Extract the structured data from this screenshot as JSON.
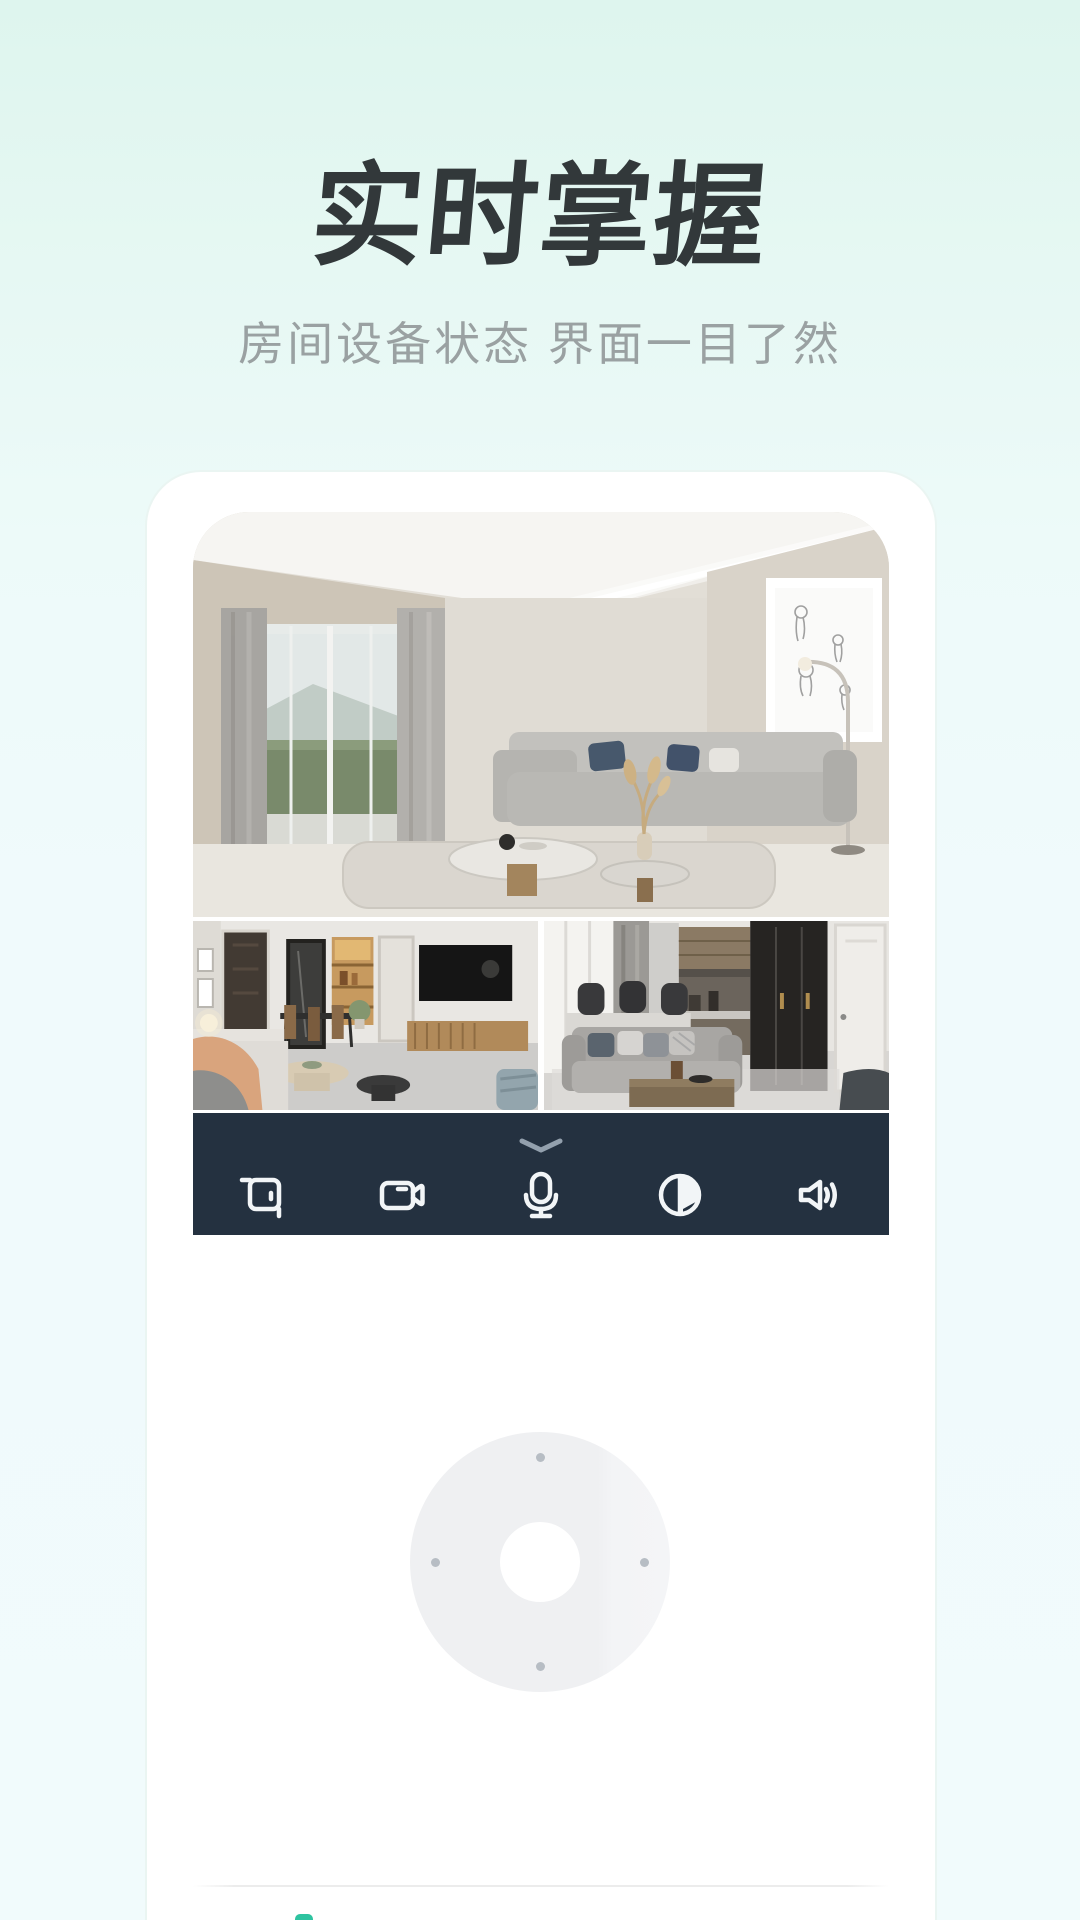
{
  "hero": {
    "title": "实时掌握",
    "subtitle": "房间设备状态 界面一目了然"
  },
  "colors": {
    "background_top": "#def5ee",
    "background_bottom": "#f1fbfc",
    "title_text": "#32383a",
    "subtitle_text": "#9aa1a2",
    "control_bar": "#243140",
    "icon_stroke": "#f2f5f7",
    "chevron": "#93a0ad",
    "dpad_ring": "#eff0f2",
    "dpad_dot": "#b7bdc4",
    "accent_teal": "#2ec3a0"
  },
  "camera": {
    "feeds": [
      {
        "id": "living-room-main",
        "kind": "main-view"
      },
      {
        "id": "dining-room",
        "kind": "thumbnail"
      },
      {
        "id": "lounge",
        "kind": "thumbnail"
      }
    ],
    "control_bar": {
      "collapse_icon": "chevron-down",
      "icons": [
        {
          "name": "crop-screenshot"
        },
        {
          "name": "video-record"
        },
        {
          "name": "microphone"
        },
        {
          "name": "contrast-theme"
        },
        {
          "name": "volume"
        }
      ]
    },
    "dpad": {
      "directions": [
        "up",
        "left",
        "right",
        "down"
      ]
    }
  }
}
